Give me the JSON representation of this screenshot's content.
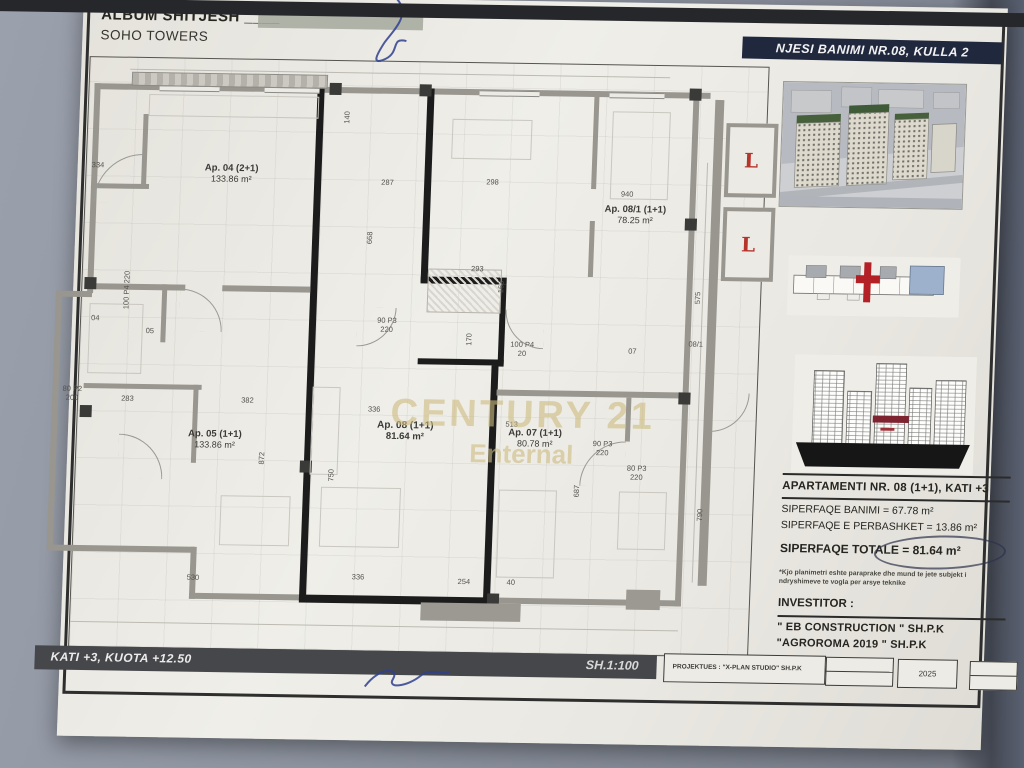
{
  "header": {
    "title": "ALBUM SHITJESH",
    "title_suffix": "____",
    "subtitle": "SOHO TOWERS",
    "banner": "NJESI BANIMI NR.08, KULLA 2"
  },
  "watermark": {
    "line1": "CENTURY 21",
    "line2": "Enternal"
  },
  "plan": {
    "lift_label": "L",
    "apartments": [
      {
        "name": "Ap. 04 (2+1)",
        "area": "133.86 m²",
        "x": 145,
        "y": 114,
        "bold": false
      },
      {
        "name": "Ap. 08/1 (1+1)",
        "area": "78.25 m²",
        "x": 550,
        "y": 149,
        "bold": false
      },
      {
        "name": "Ap. 05 (1+1)",
        "area": "133.86 m²",
        "x": 138,
        "y": 380,
        "bold": false
      },
      {
        "name": "Ap. 08 (1+1)",
        "area": "81.64 m²",
        "x": 328,
        "y": 369,
        "bold": true
      },
      {
        "name": "Ap. 07 (1+1)",
        "area": "80.78 m²",
        "x": 458,
        "y": 374,
        "bold": false
      }
    ],
    "dims": [
      {
        "t": "334",
        "x": 5,
        "y": 104
      },
      {
        "t": "287",
        "x": 295,
        "y": 117
      },
      {
        "t": "140",
        "x": 253,
        "y": 52,
        "v": 1
      },
      {
        "t": "298",
        "x": 400,
        "y": 115
      },
      {
        "t": "940",
        "x": 535,
        "y": 125
      },
      {
        "t": "668",
        "x": 280,
        "y": 172,
        "v": 1
      },
      {
        "t": "575",
        "x": 610,
        "y": 227,
        "v": 1
      },
      {
        "t": "293",
        "x": 388,
        "y": 202
      },
      {
        "t": "163",
        "x": 413,
        "y": 219,
        "v": 1
      },
      {
        "t": "90  P3\n220",
        "x": 296,
        "y": 255
      },
      {
        "t": "170",
        "x": 383,
        "y": 272,
        "v": 1
      },
      {
        "t": "100  P4\n20",
        "x": 430,
        "y": 277
      },
      {
        "t": "04",
        "x": 10,
        "y": 257
      },
      {
        "t": "05",
        "x": 65,
        "y": 269
      },
      {
        "t": "100 P4 220",
        "x": 26,
        "y": 228,
        "v": 1
      },
      {
        "t": "80  P2\n200",
        "x": -16,
        "y": 328
      },
      {
        "t": "283",
        "x": 43,
        "y": 337
      },
      {
        "t": "382",
        "x": 163,
        "y": 337
      },
      {
        "t": "872",
        "x": 180,
        "y": 394,
        "v": 1
      },
      {
        "t": "750",
        "x": 250,
        "y": 410,
        "v": 1
      },
      {
        "t": "336",
        "x": 290,
        "y": 344
      },
      {
        "t": "513",
        "x": 428,
        "y": 357
      },
      {
        "t": "90  P3\n220",
        "x": 516,
        "y": 375
      },
      {
        "t": "80  P3\n220",
        "x": 551,
        "y": 399
      },
      {
        "t": "687",
        "x": 496,
        "y": 422,
        "v": 1
      },
      {
        "t": "790",
        "x": 620,
        "y": 444,
        "v": 1
      },
      {
        "t": "530",
        "x": 115,
        "y": 515
      },
      {
        "t": "336",
        "x": 280,
        "y": 512
      },
      {
        "t": "254",
        "x": 386,
        "y": 515
      },
      {
        "t": "40",
        "x": 435,
        "y": 515
      },
      {
        "t": "08/1",
        "x": 608,
        "y": 274
      },
      {
        "t": "07",
        "x": 548,
        "y": 282
      }
    ]
  },
  "sidebar": {
    "apartment_title": "APARTAMENTI NR. 08 (1+1), KATI +3",
    "area_line1": "SIPERFAQE BANIMI = 67.78 m²",
    "area_line2": "SIPERFAQE E PERBASHKET = 13.86 m²",
    "total_label": "SIPERFAQE TOTALE",
    "total_value": "= 81.64 m²",
    "note": "*Kjo planimetri eshte paraprake dhe mund te jete subjekt i ndryshimeve te vogla per arsye teknike",
    "investor_label": "INVESTITOR :",
    "investors": [
      "\" EB CONSTRUCTION \" SH.P.K",
      "\"AGROROMA 2019 \" SH.P.K"
    ]
  },
  "footer": {
    "floor_label": "KATI +3, KUOTA +12.50",
    "scale": "SH.1:100",
    "designer": "PROJEKTUES :   \"X-PLAN STUDIO\" SH.P.K",
    "year": "2025"
  },
  "colors": {
    "banner_bg": "#20283e",
    "highlight_red": "#b5342c",
    "site_blue": "#9db1cc",
    "watermark_gold": "#cdbc7f"
  }
}
